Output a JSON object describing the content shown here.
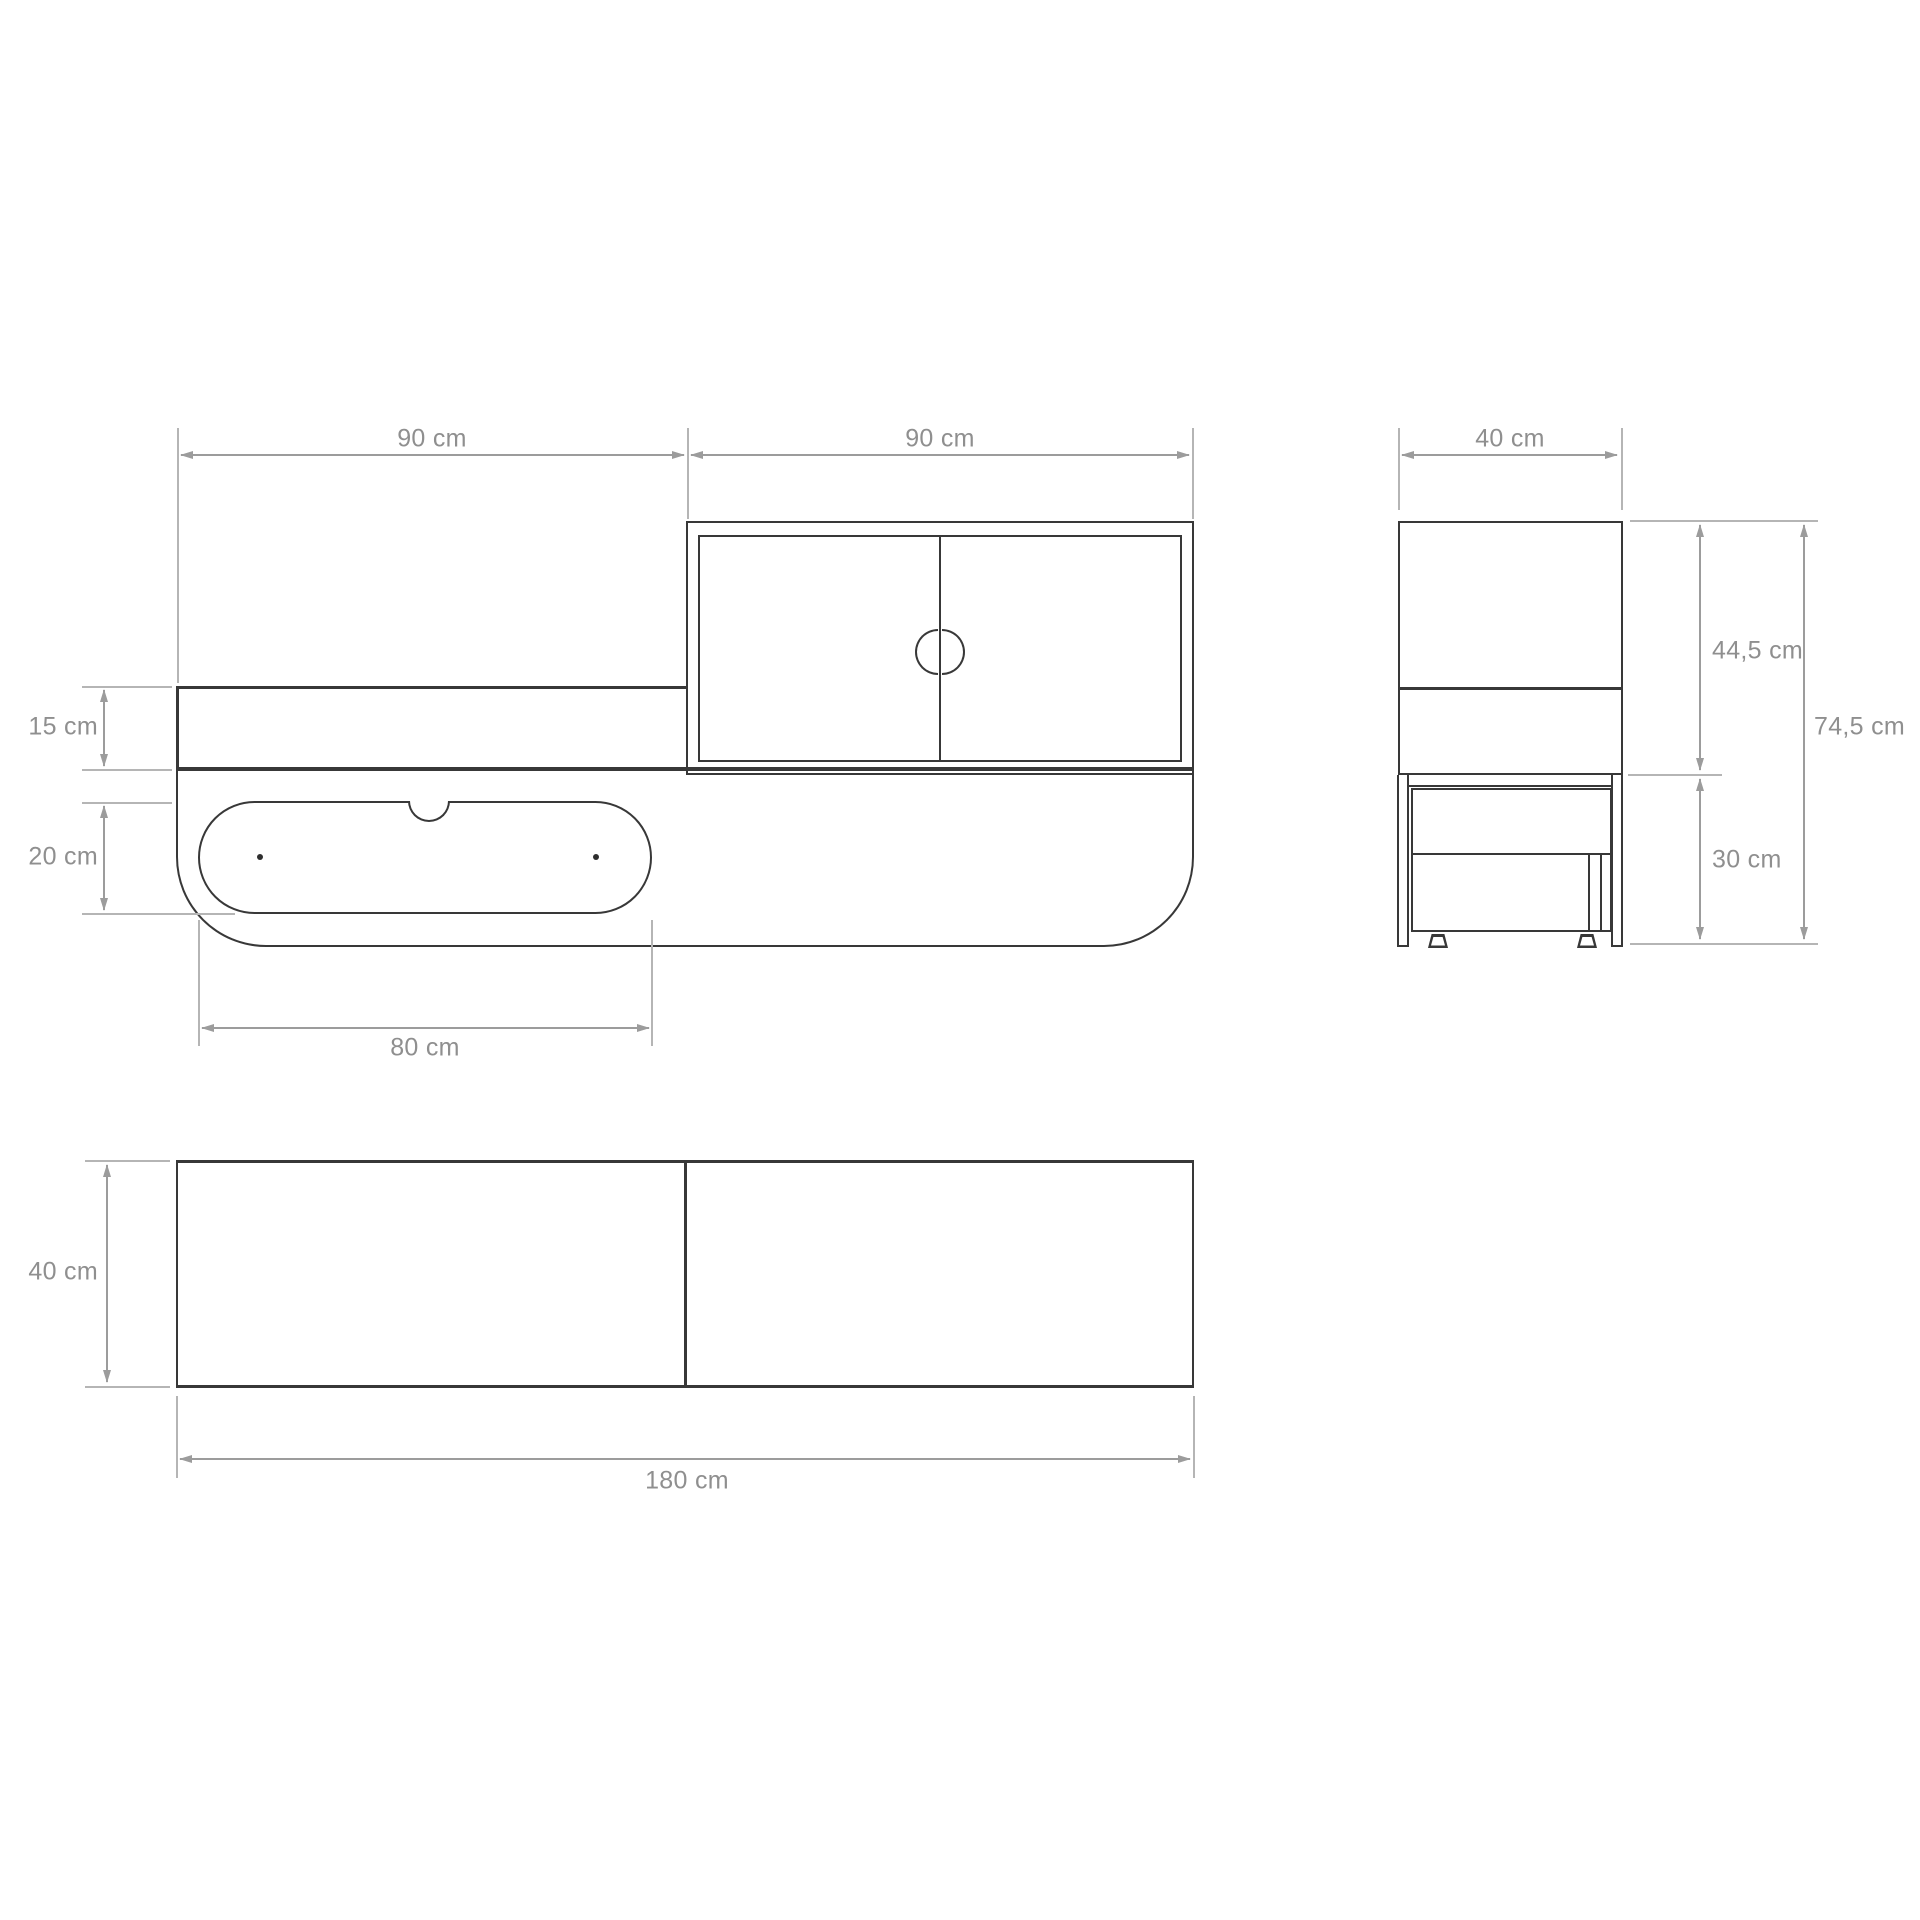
{
  "drawing": {
    "type": "furniture-dimension-diagram",
    "background": "#ffffff",
    "colors": {
      "outline": "#383838",
      "dimension_line": "#9c9c9c",
      "tick": "#b5b5b5",
      "label": "#8f8f8f"
    },
    "views": {
      "front": {
        "labels": {
          "span_left": "90 cm",
          "span_right": "90 cm",
          "shelf_height": "15 cm",
          "drawer_height": "20 cm",
          "drawer_width": "80 cm"
        }
      },
      "side": {
        "labels": {
          "depth": "40 cm",
          "upper_height": "44,5 cm",
          "total_height": "74,5 cm",
          "lower_height": "30 cm"
        }
      },
      "top": {
        "labels": {
          "depth": "40 cm",
          "total_width": "180 cm"
        }
      }
    }
  }
}
